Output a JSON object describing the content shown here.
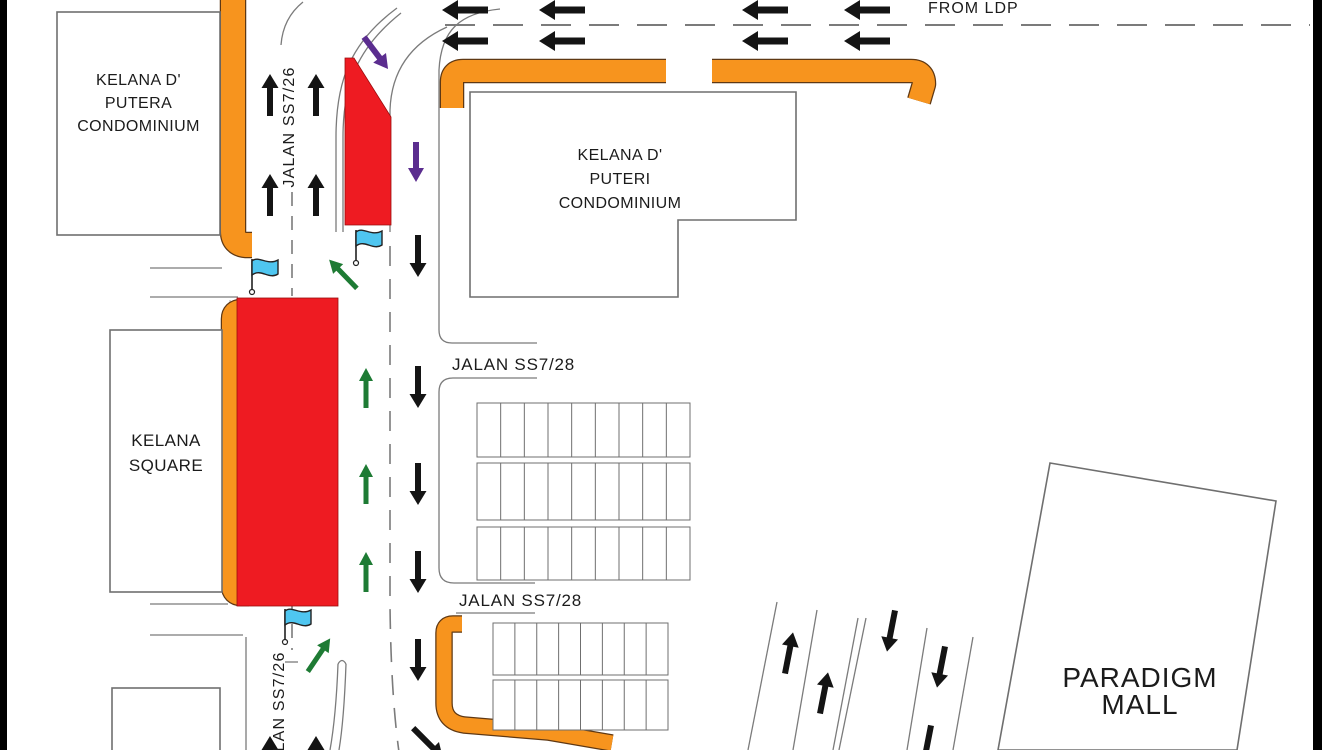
{
  "roads": {
    "jalan_ss726": "JALAN SS7/26",
    "jalan_ss728": "JALAN SS7/28",
    "from_ldp": "FROM LDP"
  },
  "buildings": {
    "kelana_d_putera": {
      "name_lines": [
        "KELANA D'",
        "PUTERA",
        "CONDOMINIUM"
      ]
    },
    "kelana_d_puteri": {
      "name_lines": [
        "KELANA D'",
        "PUTERI",
        "CONDOMINIUM"
      ]
    },
    "kelana_square": {
      "name_lines": [
        "KELANA",
        "SQUARE"
      ]
    },
    "paradigm_mall": {
      "name_lines": [
        "PARADIGM",
        "MALL"
      ]
    }
  },
  "colors": {
    "closure_red": "#ee1b22",
    "curb_orange": "#f7941e",
    "flag_blue": "#4fc6f0",
    "route_green": "#1e7b34",
    "route_purple": "#5b2d8f",
    "arrow_black": "#141414",
    "road_gray": "#7b7b7b"
  }
}
